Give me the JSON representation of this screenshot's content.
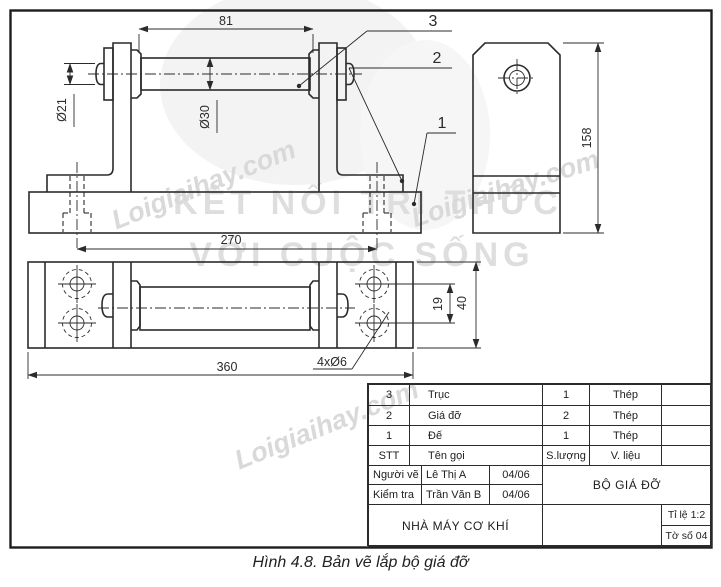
{
  "figure": {
    "caption": "Hình 4.8. Bản vẽ lắp bộ giá đỡ"
  },
  "watermarks": {
    "site": "Loigiaihay.com",
    "brand_line1": "KẾT NỐI TRI THỨC",
    "brand_line2": "VỚI CUỘC SỐNG"
  },
  "dimensions": {
    "d81": "81",
    "d21": "Ø21",
    "d30": "Ø30",
    "d270": "270",
    "d360": "360",
    "d19": "19",
    "d40": "40",
    "d158": "158",
    "holes": "4xØ6"
  },
  "part_labels": {
    "p3": "3",
    "p2": "2",
    "p1": "1"
  },
  "title_block": {
    "parts": [
      {
        "no": "3",
        "name": "Trục",
        "qty": "1",
        "material": "Thép",
        "note": ""
      },
      {
        "no": "2",
        "name": "Giá đỡ",
        "qty": "2",
        "material": "Thép",
        "note": ""
      },
      {
        "no": "1",
        "name": "Đế",
        "qty": "1",
        "material": "Thép",
        "note": ""
      }
    ],
    "headers": {
      "no": "STT",
      "name": "Tên gọi",
      "qty": "S.lượng",
      "material": "V. liệu",
      "note": ""
    },
    "drawn_by_label": "Người vẽ",
    "drawn_by": "Lê Thị A",
    "drawn_date": "04/06",
    "checked_by_label": "Kiểm tra",
    "checked_by": "Trần Văn B",
    "checked_date": "04/06",
    "assembly_name": "BỘ GIÁ ĐỠ",
    "company": "NHÀ MÁY CƠ KHÍ",
    "scale": "Tỉ lệ 1:2",
    "sheet": "Tờ số 04",
    "empty": ""
  },
  "colors": {
    "line": "#2b2b2b",
    "watermark": "#d9d9d9",
    "background": "#ffffff"
  }
}
